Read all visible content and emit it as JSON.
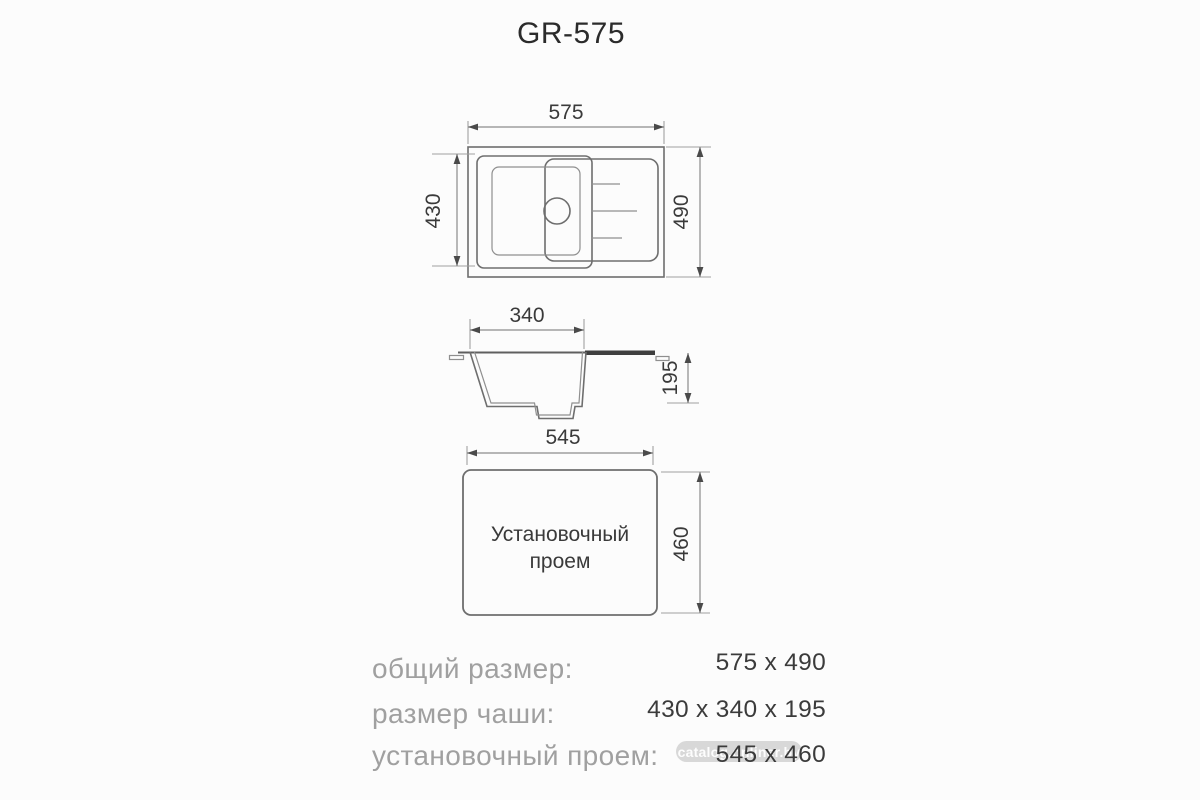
{
  "title": "GR-575",
  "top_view": {
    "width_label": "575",
    "height_label": "490",
    "bowl_height_label": "430"
  },
  "section_view": {
    "bowl_width_label": "340",
    "depth_label": "195"
  },
  "install_view": {
    "width_label": "545",
    "height_label": "460",
    "caption_line1": "Установочный",
    "caption_line2": "проем"
  },
  "specs": {
    "rows": [
      {
        "label": "общий размер:",
        "value": "575 x 490"
      },
      {
        "label": "размер чаши:",
        "value": "430 x 340 x 195"
      },
      {
        "label": "установочный проем:",
        "value": "545 x 460"
      }
    ]
  },
  "watermark": {
    "text": "catalog.onliner.by"
  },
  "colors": {
    "background": "#fcfcfc",
    "drawing_line": "#6e6e6e",
    "dimension_line": "#8c8c8c",
    "dark_text": "#3a3a3a",
    "label_gray": "#a0a0a0",
    "drainer_bar": "#3f3f3f"
  }
}
